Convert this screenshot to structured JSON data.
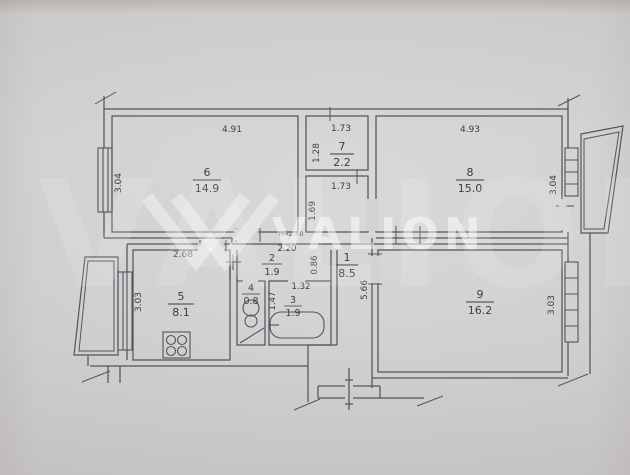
{
  "watermark": {
    "brand": "VALION"
  },
  "notes": {
    "ceiling_height": "H=2.50"
  },
  "rooms": {
    "r1": {
      "number": "1",
      "area": "8.5"
    },
    "r2": {
      "number": "2",
      "area": "1.9"
    },
    "r3": {
      "number": "3",
      "area": "1.9"
    },
    "r4": {
      "number": "4",
      "area": "0.8"
    },
    "r5": {
      "number": "5",
      "area": "8.1"
    },
    "r6": {
      "number": "6",
      "area": "14.9"
    },
    "r7": {
      "number": "7",
      "area": "2.2"
    },
    "r8": {
      "number": "8",
      "area": "15.0"
    },
    "r9": {
      "number": "9",
      "area": "16.2"
    }
  },
  "dimensions": {
    "room6_width": "4.91",
    "room6_height": "3.04",
    "room7_width": "1.73",
    "room7_height": "1.28",
    "corridor7_width": "1.73",
    "corridor7_height": "1.69",
    "room8_width": "4.93",
    "room8_height": "3.04",
    "kitchen_width": "2.68",
    "kitchen_height": "3.03",
    "hall2_width": "2.20",
    "hall2_height": "0.86",
    "hall1_height": "5.66",
    "bath_height": "1.47",
    "bath_width": "1.32",
    "room9_height": "3.03"
  },
  "colors": {
    "paper": "#d5d3d2",
    "ink": "#4d4d55",
    "watermark": "#ffffff"
  }
}
